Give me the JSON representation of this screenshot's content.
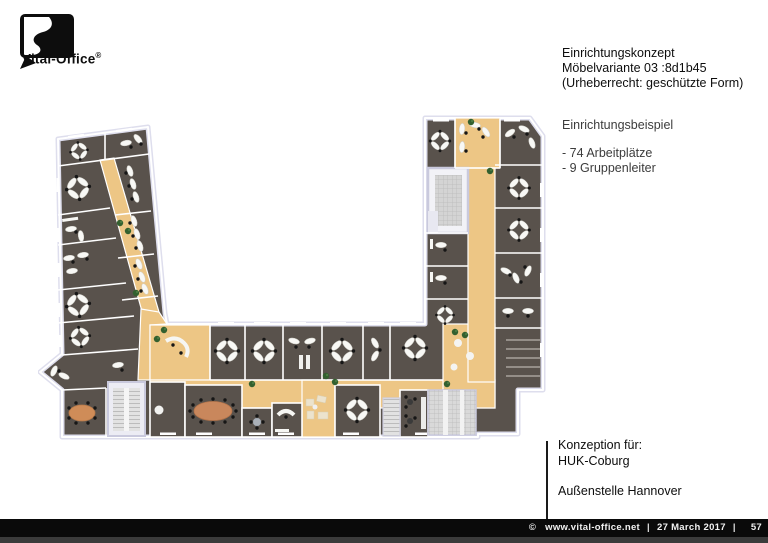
{
  "page": {
    "width_px": 768,
    "height_px": 543,
    "background": "#ffffff"
  },
  "logo": {
    "brand": "Vital-Office",
    "registered_mark": "®"
  },
  "concept_header": {
    "line1": "Einrichtungskonzept",
    "line2": "Möbelvariante 03 :8d1b45",
    "line3": "(Urheberrecht: geschützte Form)"
  },
  "example_block": {
    "title": "Einrichtungsbeispiel",
    "items": [
      "- 74 Arbeitplätze",
      "- 9 Gruppenleiter"
    ]
  },
  "client_block": {
    "label": "Konzeption für:",
    "client": "HUK-Coburg",
    "location": "Außenstelle Hannover"
  },
  "footer": {
    "copyright_symbol": "©",
    "website": "www.vital-office.net",
    "separator": "|",
    "date": "27 March 2017",
    "page_number": "57"
  },
  "floor_plan": {
    "type": "office-floor-plan-top-view",
    "shape": "U-shaped building: slanted left wing, horizontal bottom wing, vertical right wing around a white courtyard",
    "features": [
      "corridor loop with sand-colored floor",
      "cellular offices with kidney-shaped desks",
      "4-desk cross-shaped team clusters",
      "meeting rooms with oval tables",
      "reception counter",
      "lounge seating",
      "staircases and atrium",
      "plants along corridors"
    ],
    "colors": {
      "corridor_floor": "#edc685",
      "office_floor": "#59524c",
      "inner_walls": "#ffffff",
      "outer_wall": "#dedeed",
      "desks": "#f8f8f5",
      "chairs": "#161616",
      "plants": "#33602f",
      "meeting_table": "#c9875c",
      "stairs": "#d9d9d9",
      "lounge_furniture": "#ece3cd"
    }
  }
}
